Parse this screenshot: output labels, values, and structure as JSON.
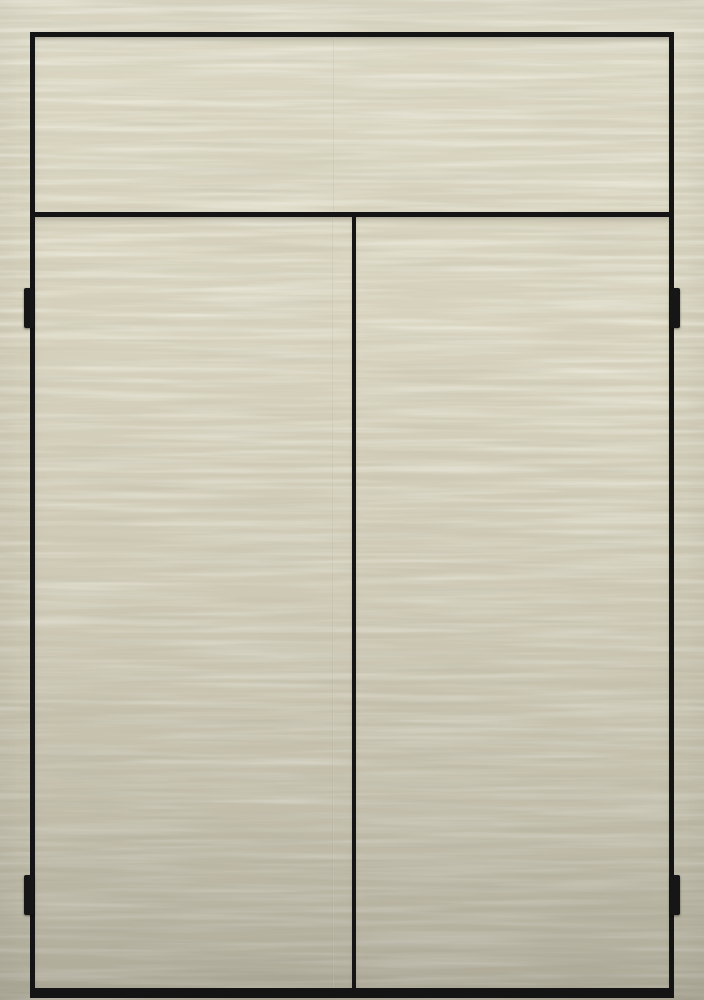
{
  "image": {
    "type": "product-photo",
    "subject": "Cream woodgrain-textured cabinet front with black trim, upper panel, two doors and four black side hinges",
    "parts": {
      "scene": "cabinet photo",
      "texture": "horizontal wavy woodgrain texture",
      "frame": "black cabinet trim frame",
      "top_panel": "upper fixed panel",
      "left_door": "left door panel",
      "right_door": "right door panel",
      "top_rail": "horizontal trim rail",
      "center_stile": "center vertical trim stile",
      "kick_plate": "black bottom kick plate",
      "seam_top": "faint texture seam on upper panel",
      "seam_door": "faint texture seam on left door",
      "hinge_top_left": "top left hinge",
      "hinge_bottom_left": "bottom left hinge",
      "hinge_top_right": "top right hinge",
      "hinge_bottom_right": "bottom right hinge"
    },
    "colors": {
      "base": "#d6d2bd",
      "grain_highlight": "#e2deca",
      "grain_shadow": "#c6c2ad",
      "bottom_shade": "#bdb8a6",
      "trim": "#141414",
      "hinge": "#161616"
    }
  }
}
